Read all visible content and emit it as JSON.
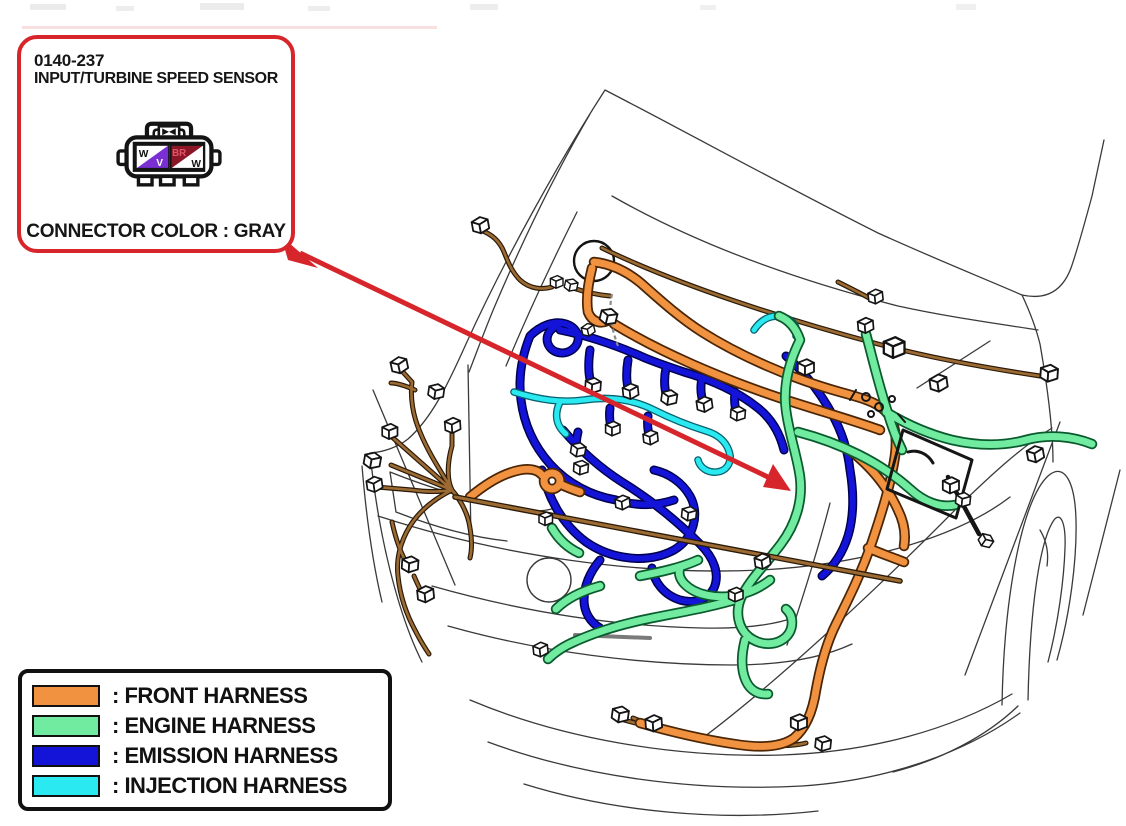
{
  "callout": {
    "code": "0140-237",
    "title": "INPUT/TURBINE SPEED SENSOR",
    "connector_color": "CONNECTOR COLOR : GRAY",
    "connector": {
      "pins": [
        {
          "label": "W"
        },
        {
          "label": "V"
        },
        {
          "label": "BR"
        },
        {
          "label": "W"
        }
      ]
    }
  },
  "legend": {
    "items": [
      {
        "label": ": FRONT HARNESS",
        "color_key": "front"
      },
      {
        "label": ": ENGINE HARNESS",
        "color_key": "engine"
      },
      {
        "label": ": EMISSION HARNESS",
        "color_key": "emission"
      },
      {
        "label": ": INJECTION HARNESS",
        "color_key": "injection"
      }
    ]
  },
  "colors": {
    "front": "#F0923F",
    "engine": "#70EBA0",
    "emission": "#1414D8",
    "injection": "#2BE9F0",
    "accent_red": "#D6252B",
    "wire_brown": "#9C6B33",
    "pin_violet": "#7A2FD4",
    "pin_brown": "#8B1726",
    "pin_brown_text": "#E05568",
    "body_line": "#3a3a3a"
  }
}
